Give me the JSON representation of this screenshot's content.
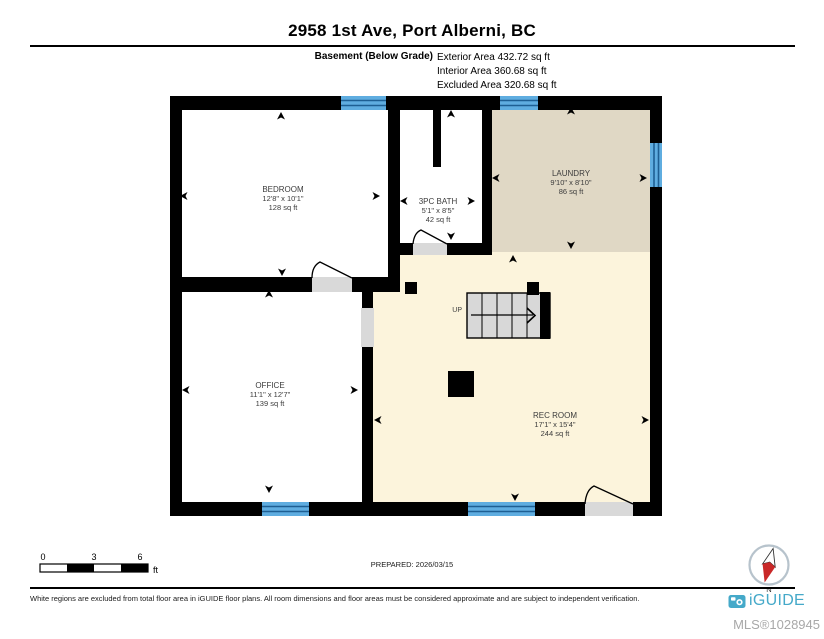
{
  "header": {
    "title": "2958 1st Ave, Port Alberni, BC",
    "floor_label": "Basement (Below Grade)",
    "area_lines": [
      "Exterior Area 432.72 sq ft",
      "Interior Area 360.68 sq ft",
      "Excluded Area 320.68 sq ft"
    ]
  },
  "rooms": [
    {
      "name": "BEDROOM",
      "dimensions": "12'8\" x 10'1\"",
      "area": "128 sq ft"
    },
    {
      "name": "3PC BATH",
      "dimensions": "5'1\" x 8'5\"",
      "area": "42 sq ft"
    },
    {
      "name": "LAUNDRY",
      "dimensions": "9'10\" x 8'10\"",
      "area": "86 sq ft"
    },
    {
      "name": "OFFICE",
      "dimensions": "11'1\" x 12'7\"",
      "area": "139 sq ft"
    },
    {
      "name": "REC ROOM",
      "dimensions": "17'1\" x 15'4\"",
      "area": "244 sq ft"
    }
  ],
  "stairs": {
    "direction_label": "UP"
  },
  "scale_bar": {
    "tick_labels": [
      "0",
      "3",
      "6"
    ],
    "unit_label": "ft"
  },
  "compass": {
    "north_label": "N"
  },
  "footer": {
    "prepared_label": "PREPARED: 2026/03/15",
    "disclaimer": "White regions are excluded from total floor area in iGUIDE floor plans. All room dimensions and floor areas must be considered approximate and are subject to independent verification.",
    "brand": "iGUIDE",
    "mls_number": "MLS®1028945"
  },
  "colors": {
    "wall": "#000000",
    "window_blue": "#5fade0",
    "window_stripe": "#1e5f93",
    "floor_interior_cream": "#fcf4dc",
    "floor_laundry_tan": "#e0d8c5",
    "floor_excluded_white": "#ffffff",
    "door_threshold_gray": "#d9d9d9",
    "stair_gray": "#d8d8d8",
    "brand_teal": "#45a9c9",
    "compass_red": "#c92828",
    "mls_gray": "#a8a8a8"
  }
}
